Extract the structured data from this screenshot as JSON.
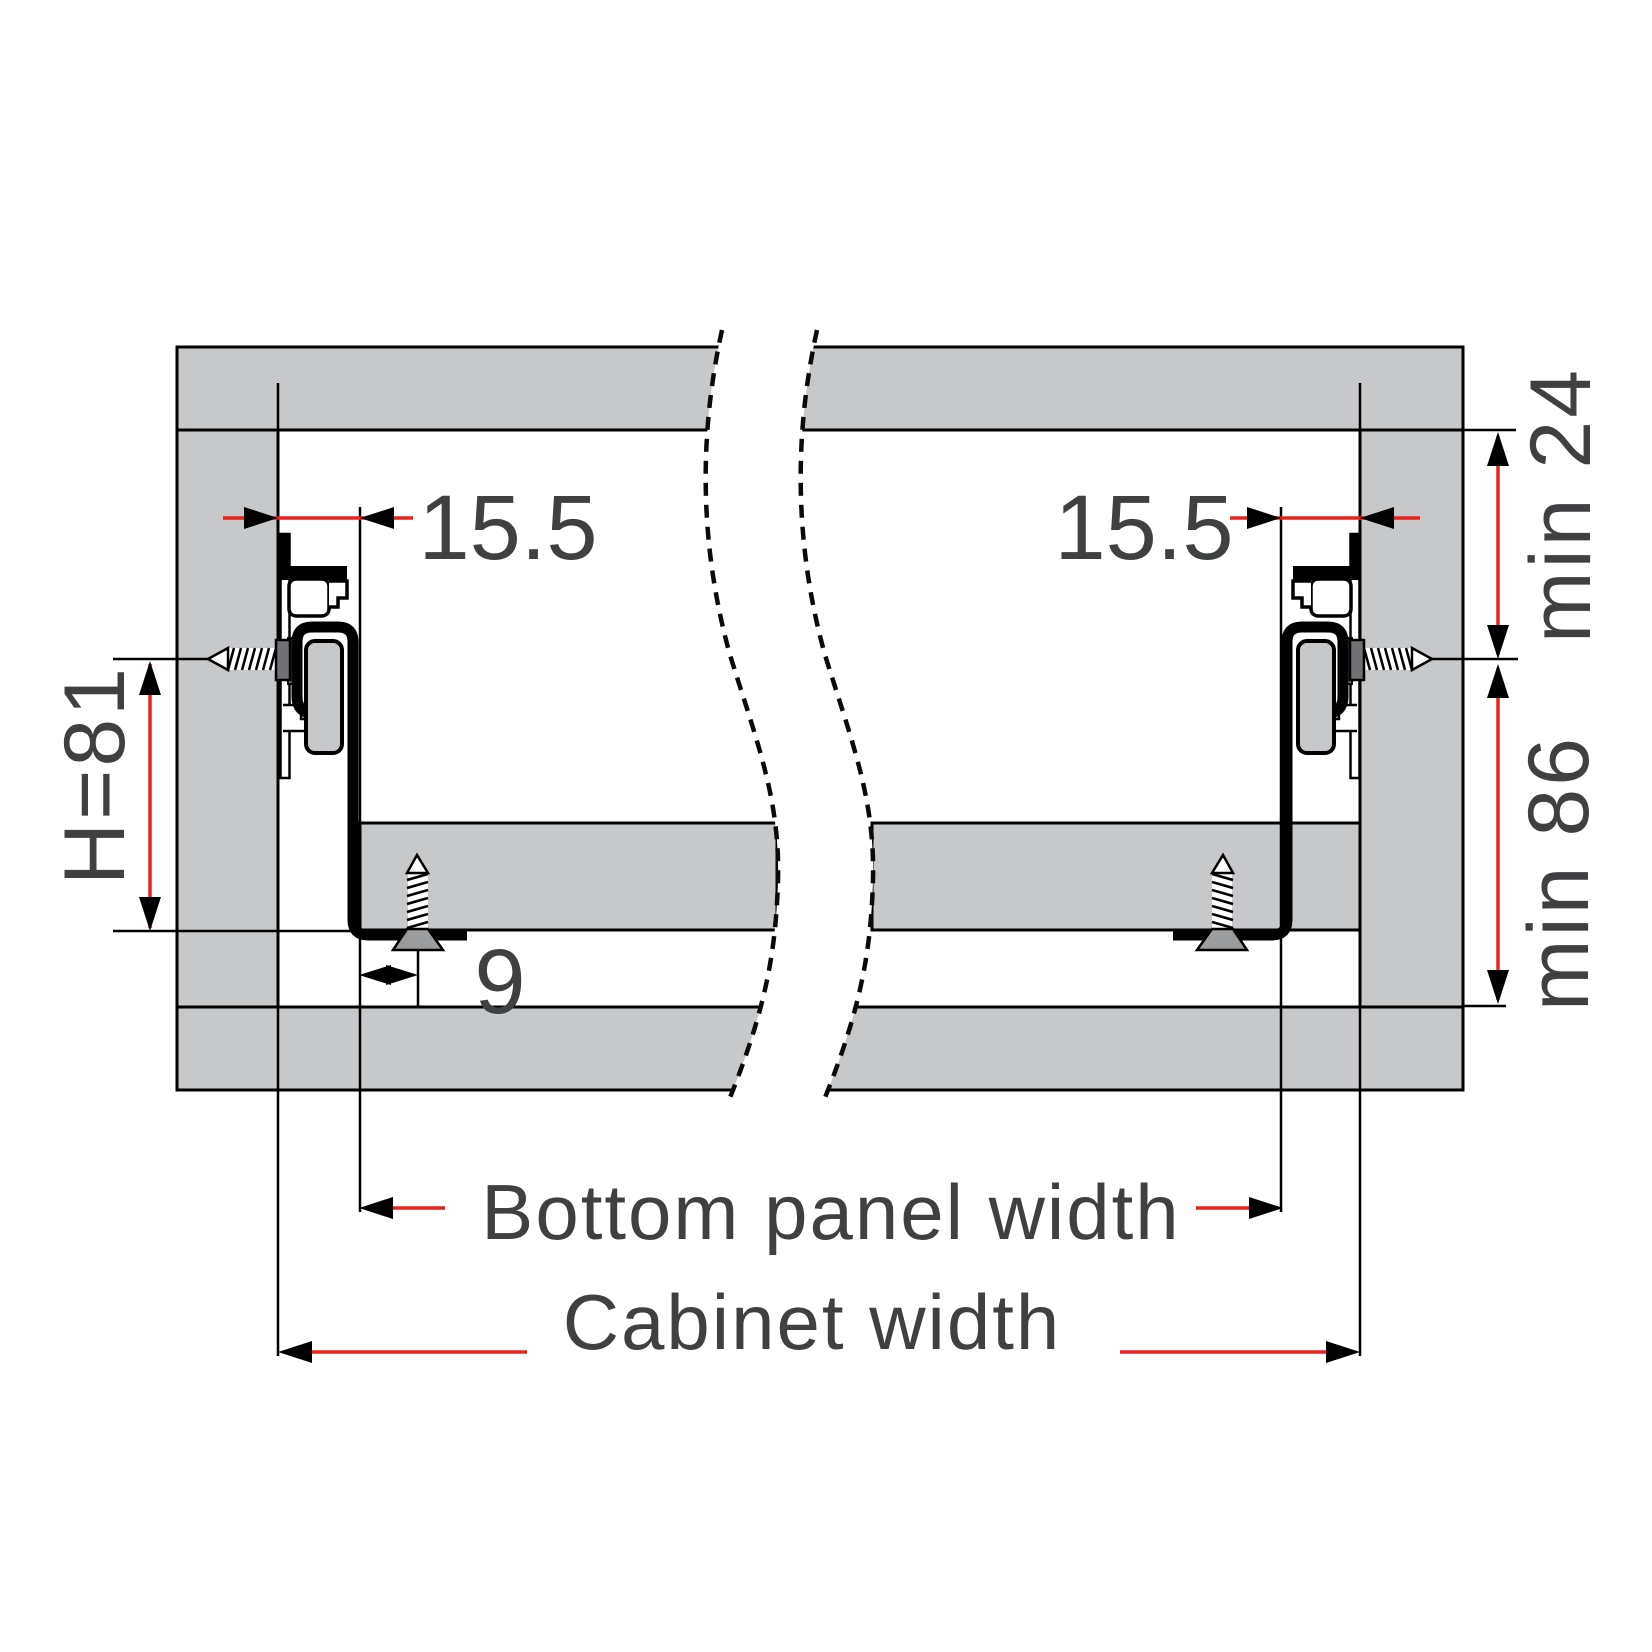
{
  "diagram": {
    "type": "drawer-slide-installation-cross-section",
    "labels": {
      "slide_offset_left": "15.5",
      "slide_offset_right": "15.5",
      "mounting_height": "H=81",
      "screw_inset": "9",
      "top_clearance_min": "min 24",
      "interior_height_min": "min 86",
      "bottom_panel_width": "Bottom panel width",
      "cabinet_width": "Cabinet width"
    },
    "colors": {
      "panel_fill": "#c7c8ca",
      "outline": "#000000",
      "dimension_line_red": "#e8231f",
      "label_text": "#3f4042",
      "screw_head_gray": "#9b9c9e",
      "background": "#ffffff"
    },
    "icons": [
      "screw-icon",
      "dimension-arrow-icon",
      "break-line-icon"
    ]
  }
}
